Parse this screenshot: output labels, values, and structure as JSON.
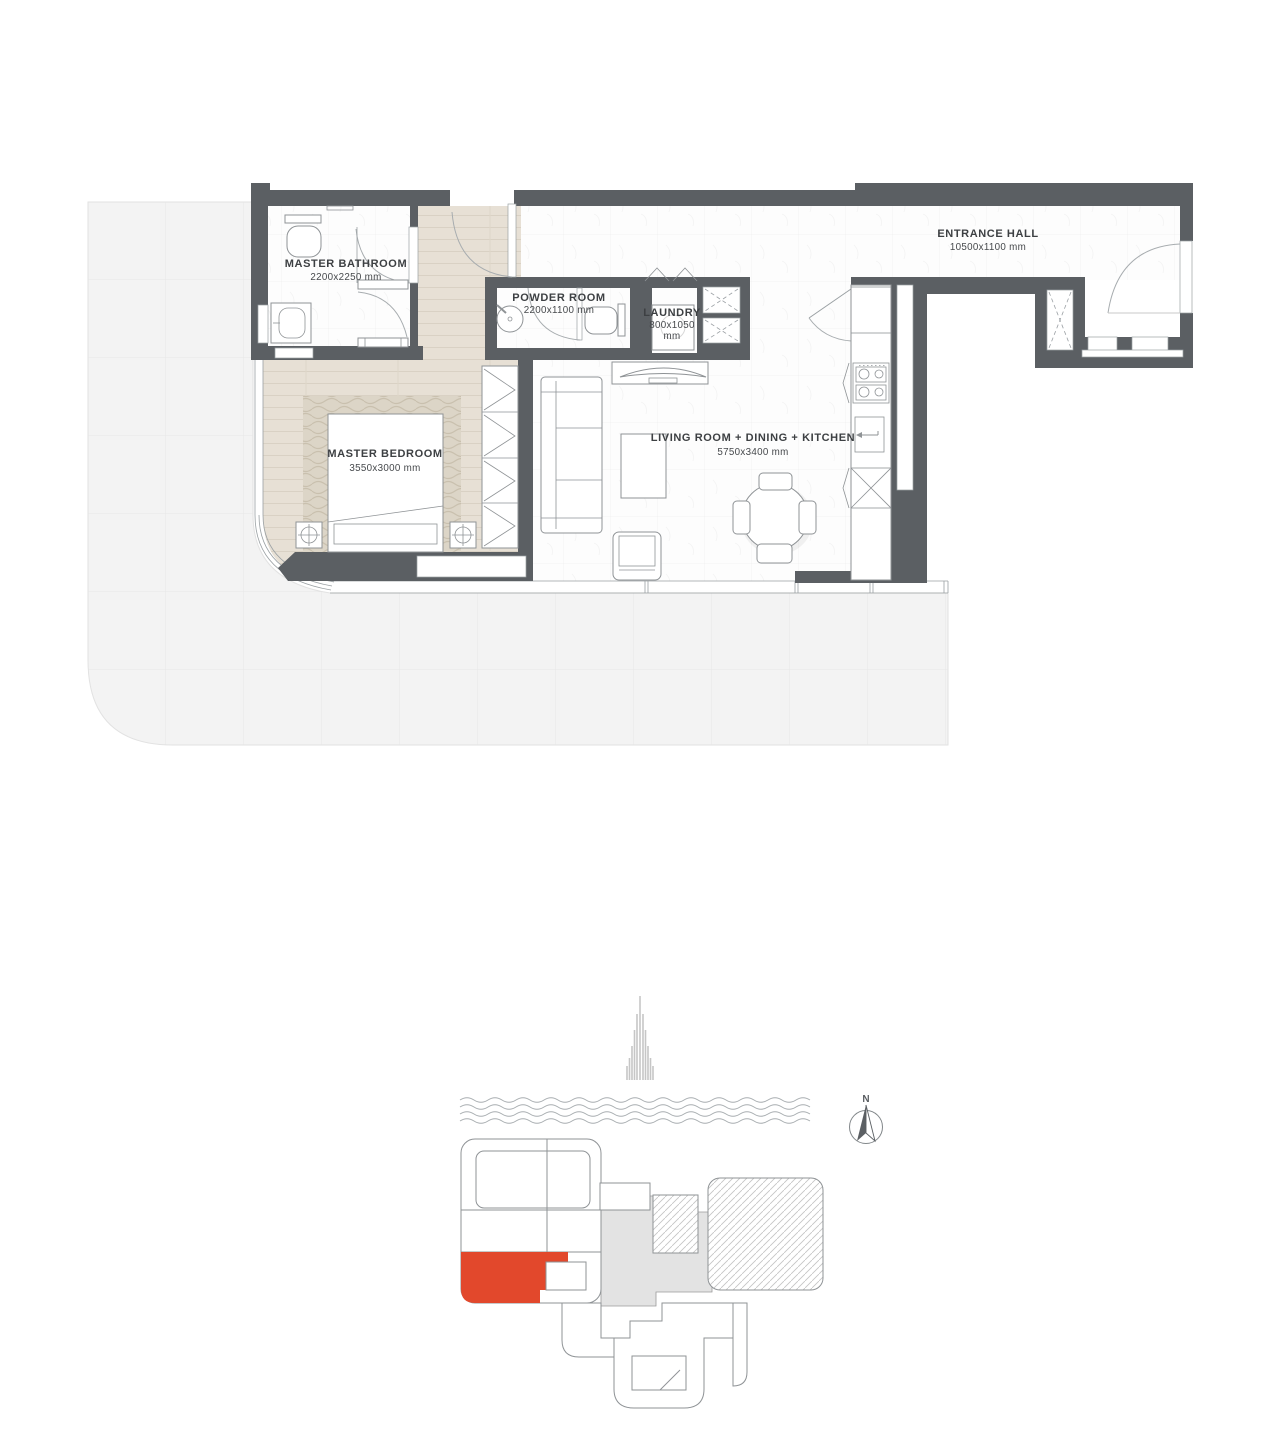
{
  "floor_plan": {
    "rooms": {
      "master_bathroom": {
        "name": "MASTER BATHROOM",
        "dims": "2200x2250 mm"
      },
      "powder_room": {
        "name": "POWDER ROOM",
        "dims": "2200x1100 mm"
      },
      "laundry": {
        "name": "LAUNDRY",
        "dims_line1": "800x1050",
        "dims_line2": "mm"
      },
      "entrance_hall": {
        "name": "ENTRANCE HALL",
        "dims": "10500x1100 mm"
      },
      "master_bedroom": {
        "name": "MASTER BEDROOM",
        "dims": "3550x3000 mm"
      },
      "living": {
        "name": "LIVING ROOM + DINING  + KITCHEN",
        "dims": "5750x3400 mm"
      }
    }
  },
  "key_plan": {
    "north_label": "N"
  },
  "colors": {
    "wall": "#5b5f63",
    "unit_highlight": "#e2482c",
    "wood_floor": "#e7e0d5",
    "terrace": "#f3f3f3",
    "hatch_region": "#c4c4c4"
  }
}
